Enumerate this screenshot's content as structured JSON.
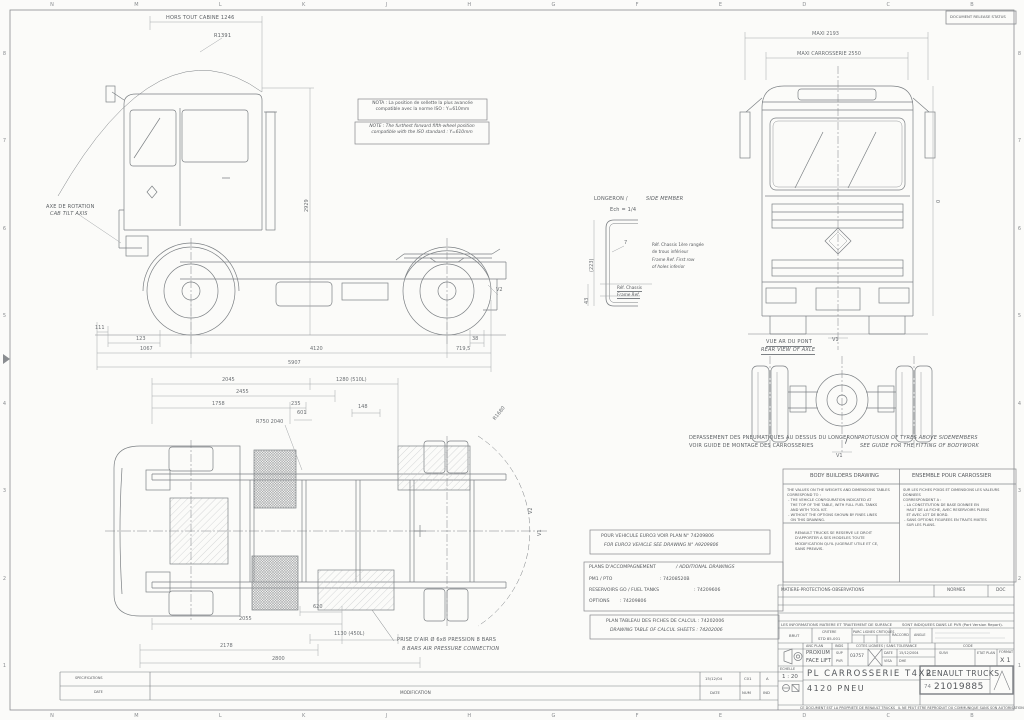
{
  "stamp": "DOCUMENT RELEASE STATUS",
  "colors": {
    "paper": "#fbfbf9",
    "line": "#7c8084",
    "dim_line": "#a3a6a9",
    "text": "#55585c"
  },
  "grid": {
    "cols": [
      "N",
      "M",
      "L",
      "K",
      "J",
      "H",
      "G",
      "F",
      "E",
      "D",
      "C",
      "B"
    ],
    "rows": [
      "8",
      "7",
      "6",
      "5",
      "4",
      "3",
      "2",
      "1"
    ]
  },
  "side_view": {
    "cab_overall": "HORS TOUT CABINE 1246",
    "radius": "R1391",
    "tilt_fr": "AXE DE ROTATION",
    "tilt_en": "CAB TILT AXIS",
    "height": "2929",
    "v2": "V2",
    "d111": "111",
    "d123": "123",
    "d1067": "1067",
    "d4120": "4120",
    "d38": "38",
    "d719": "719,5",
    "d5907": "5907"
  },
  "front_view": {
    "maxi": "MAXI 2193",
    "maxi_body": "MAXI CARROSSERIE 2550",
    "v1": "V1",
    "zero": "0"
  },
  "rear_axle": {
    "label_fr": "VUE AR DU PONT",
    "label_en": "REAR VIEW OF AXLE",
    "v1": "V1"
  },
  "plan_view": {
    "d2045": "2045",
    "d2455": "2455",
    "d1758": "1758",
    "d235": "235",
    "d601": "601",
    "d148": "148",
    "d1280": "1280 (510L)",
    "r750": "R750 2040",
    "r1680": "R1680",
    "d620": "620",
    "d1130": "1130 (450L)",
    "d2055": "2055",
    "d2178": "2178",
    "d2800": "2800",
    "v2": "V2",
    "v1": "V1"
  },
  "longeron": {
    "title_fr": "LONGERON /",
    "title_en": "SIDE MEMBER",
    "scale": "Ech = 1/4",
    "web": "7",
    "height": "(223)",
    "bottom": "43",
    "ref_row_fr1": "Réf. Chassis 1ère rangée",
    "ref_row_fr2": "de trous inférieur",
    "ref_row_en1": "Frame Ref. First row",
    "ref_row_en2": "of holes inferior",
    "ref_fr": "Réf. Chassis",
    "ref_en": "Frame Ref."
  },
  "notes": {
    "nota_fr": "NOTA : La position de sellette la plus avancée\ncompatible avec la norme ISO : Y=610mm",
    "note_en": "NOTE : The furthest forward fifth-wheel position\ncompatible with the ISO standard : Y=610mm",
    "tyres_fr1": "DEPASSEMENT DES PNEUMATIQUES AU DESSUS DU LONGERON",
    "tyres_fr2": "VOIR GUIDE DE MONTAGE DES CARROSSERIES",
    "tyres_sep": "/",
    "tyres_en1": "PROTUSION OF TYRES ABOVE SIDEMEMBERS",
    "tyres_en2": "SEE GUIDE FOR THE FITTING OF BODYWORK",
    "air_fr": "PRISE D'AIR Ø 6x8 PRESSION 8 BARS",
    "air_en": "8 BARS AIR PRESSURE CONNECTION",
    "euro3_fr": "POUR VEHICULE EURO3 VOIR PLAN N° 74209806",
    "euro3_en": "FOR EURO3 VEHICLE SEE DRAWING N° A9209806",
    "calc_fr": "PLAN TABLEAU DES FICHES DE CALCUL : 74202006",
    "calc_en": "DRAWING TABLE OF CALCUL SHEETS : 74202006"
  },
  "additional": {
    "title_fr": "PLANS D'ACCOMPAGNEMENT",
    "title_en": "/ ADDITIONAL DRAWINGS",
    "rows": [
      {
        "label": "PM1 / PTO",
        "value": ": 74208520B"
      },
      {
        "label": "RESERVOIRS GO / FUEL TANKS",
        "value": ": 74209606"
      },
      {
        "label": "OPTIONS",
        "value": ": 74209806"
      }
    ]
  },
  "bodybuilders": {
    "header_en": "BODY BUILDERS DRAWING",
    "header_fr": "ENSEMBLE POUR CARROSSIER",
    "text_en": "THE VALUES ON THE WEIGHTS AND DIMENSIONS TABLES\nCORRESPOND TO :\n - THE VEHICLE CONFIGURATION INDICATED AT\n   THE TOP OF THE TABLE, WITH FULL FUEL TANKS\n   AND WITH TOOL KIT.\n - WITHOUT THE OPTIONS SHOWN BY FINES LINES\n   ON THIS DRAWING.",
    "text_fr": "SUR LES FICHES POIDS ET DIMENSIONS LES VALEURS DONNEES\nCORRESPONDENT A :\n - LA CONSTITUTION DE BASE DONNEE EN\n   HAUT DE LA FICHE, AVEC RESERVOIRS PLEINS\n   ET AVEC LOT DE BORD.\n - SANS OPTIONS FIGUREES EN TRAITS MIXTES\n   SUR LES PLANS.",
    "reserve": "RENAULT TRUCKS SE RESERVE LE DROIT\nD'APPORTER A SES MODELES TOUTE\nMODIFICATION QU'IL JUGERAIT UTILE ET CE,\nSANS PREAVIS."
  },
  "titleblock": {
    "matiere": "MATIERE-PROTECTIONS-OBSERVATIONS",
    "normes": "NORMES",
    "doc": "DOC",
    "info_left": "LES INFORMATIONS MATIERE ET TRAITEMENT DE SURFACE",
    "info_right": "SONT INDIQUEES DANS LE PVR (Part Version Report).",
    "brut": "BRUT",
    "critere": "CRITERE",
    "critere_val": "STD 85-001",
    "parc": "PARC LIGNES CRITIQUES",
    "raccord": "RACCORD",
    "angle": "ANGLE",
    "anc_plan": "ANC PLAN",
    "model1": "PROXIUM",
    "model2": "FACE LIFT",
    "inds": "INDS",
    "sup": "SUP",
    "pvr": "PVR",
    "cotes": "COTES LIGNEES / SANS TOLERANCE",
    "ref_num": "03757",
    "date_label": "DATE",
    "date_val": "15/12/2004",
    "visa_label": "VISA",
    "visa_val": "DHE",
    "code": "CODE",
    "suivi": "SUIVI",
    "etat": "ETAT PLAN",
    "format_label": "FORMAT",
    "format_val": "X 1",
    "echelle_label": "ECHELLE",
    "echelle_val": "1 : 20",
    "title1": "PL CARROSSERIE T4X2",
    "title2": "4120 PNEU",
    "company": "RENAULT TRUCKS",
    "number_prefix": "74",
    "number": "21019885",
    "legal_left": "CE DOCUMENT EST LA PROPRIETE DE RENAULT TRUCKS",
    "legal_right": "IL NE PEUT ETRE REPRODUIT OU COMMUNIQUE SANS SON AUTORISATION"
  },
  "modifications": {
    "headers": [
      "MODIFICATION",
      "DATE",
      "NUM",
      "IND"
    ],
    "date": "15/12/04",
    "num": "C01",
    "ind": "A",
    "spec": "SPECIFICATIONS",
    "spec_date": "DATE"
  }
}
